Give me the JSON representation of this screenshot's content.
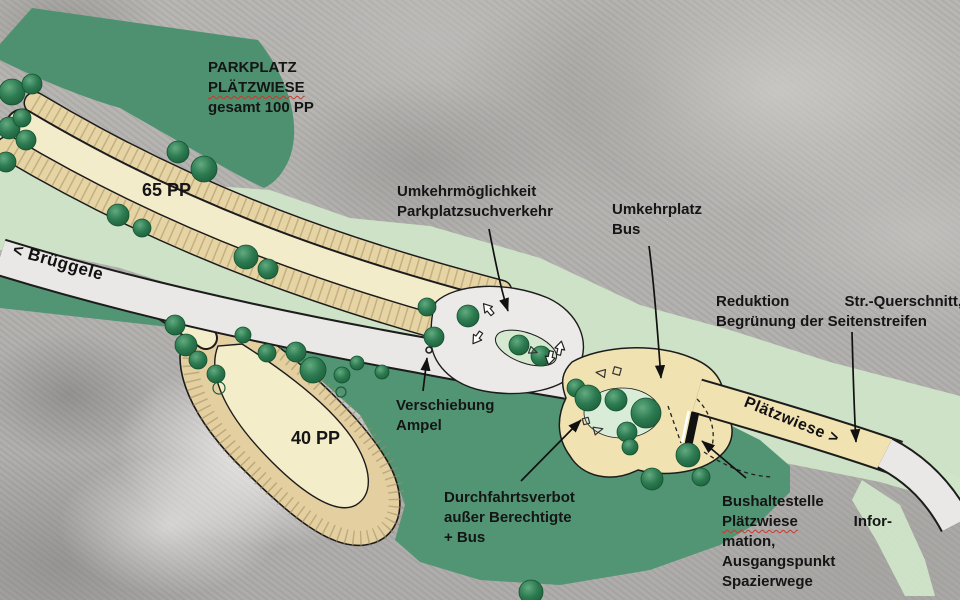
{
  "title": {
    "line1": "PARKPLATZ",
    "line2": "PLÄTZWIESE",
    "line3": "gesamt 100 PP"
  },
  "parking": {
    "p65": "65 PP",
    "p40": "40 PP"
  },
  "road_labels": {
    "left": "< Brüggele",
    "right": "Plätzwiese >"
  },
  "annotations": {
    "umkehr": {
      "line1": "Umkehrmöglichkeit",
      "line2": "Parkplatzsuchverkehr"
    },
    "umkehrplatz": {
      "line1": "Umkehrplatz",
      "line2": "Bus"
    },
    "reduktion": {
      "line1a": "Reduktion",
      "line1b": "Str.-Querschnitt,",
      "line2": "Begrünung der Seitenstreifen"
    },
    "verschiebung": {
      "line1": "Verschiebung",
      "line2": "Ampel"
    },
    "durchfahrt": {
      "line1": "Durchfahrtsverbot",
      "line2": "außer Berechtigte",
      "line3": "+ Bus"
    },
    "bushaltestelle": {
      "line1": "Bushaltestelle",
      "line2a": "Plätzwiese",
      "line2b": "Infor-",
      "line3": "mation,",
      "line4": "Ausgangspunkt",
      "line5": "Spazierwege"
    }
  },
  "legend_semantics": {
    "forest_color": "#4e9170",
    "meadow_color": "#cfe5c8",
    "parking_stall_color": "#e7d4a5",
    "parking_aisle_color": "#f3ecca",
    "road_white_color": "#e9e8e6",
    "road_beige_color": "#f1e2b2",
    "tree_color": "#2c7a50",
    "spellcheck_underline_color": "#c43a2e",
    "text_color": "#151515"
  }
}
